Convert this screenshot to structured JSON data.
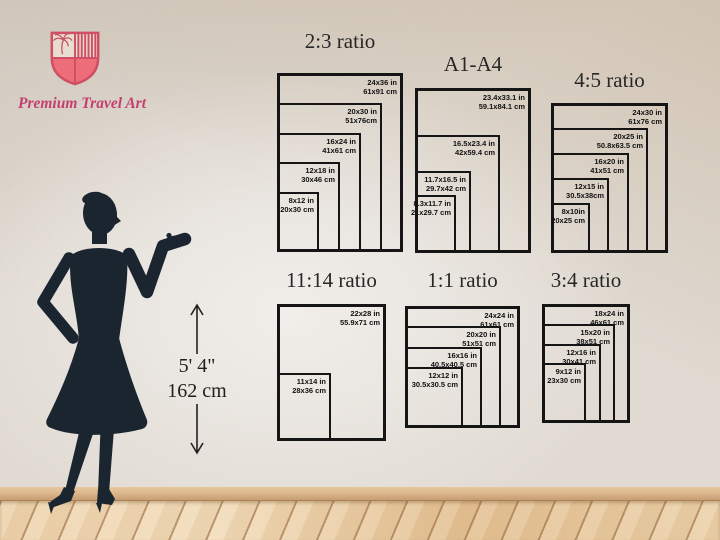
{
  "brand": {
    "name": "Premium Travel Art"
  },
  "height_marker": {
    "feet": "5' 4\"",
    "cm": "162 cm"
  },
  "colors": {
    "shield_outline": "#cf5064",
    "shield_fill": "#ee6d78",
    "brand_text": "#c43f6d",
    "silhouette": "#1b2530",
    "frame_border": "#151515",
    "wall": "#e0dad2",
    "floor_wood": "#ead0ab"
  },
  "groups": [
    {
      "title": "2:3 ratio",
      "title_top": 31,
      "frame": {
        "left": 277,
        "top": 73,
        "width": 126,
        "height": 179
      },
      "sizes": [
        {
          "label_in": "24x36 in",
          "label_cm": "61x91 cm",
          "w": 126,
          "h": 179
        },
        {
          "label_in": "20x30 in",
          "label_cm": "51x76cm",
          "w": 105,
          "h": 149
        },
        {
          "label_in": "16x24 in",
          "label_cm": "41x61 cm",
          "w": 84,
          "h": 119
        },
        {
          "label_in": "12x18 in",
          "label_cm": "30x46 cm",
          "w": 63,
          "h": 90
        },
        {
          "label_in": "8x12 in",
          "label_cm": "20x30 cm",
          "w": 42,
          "h": 60
        }
      ]
    },
    {
      "title": "A1-A4",
      "title_top": 54,
      "frame": {
        "left": 415,
        "top": 88,
        "width": 116,
        "height": 165
      },
      "sizes": [
        {
          "label_in": "23.4x33.1 in",
          "label_cm": "59.1x84.1 cm",
          "w": 116,
          "h": 165
        },
        {
          "label_in": "16.5x23.4 in",
          "label_cm": "42x59.4 cm",
          "w": 85,
          "h": 118
        },
        {
          "label_in": "11.7x16.5 in",
          "label_cm": "29.7x42 cm",
          "w": 56,
          "h": 82
        },
        {
          "label_in": "8.3x11.7 in",
          "label_cm": "21x29.7 cm",
          "w": 41,
          "h": 58
        }
      ]
    },
    {
      "title": "4:5 ratio",
      "title_top": 70,
      "frame": {
        "left": 551,
        "top": 103,
        "width": 117,
        "height": 150
      },
      "sizes": [
        {
          "label_in": "24x30 in",
          "label_cm": "61x76 cm",
          "w": 117,
          "h": 150
        },
        {
          "label_in": "20x25 in",
          "label_cm": "50.8x63.5 cm",
          "w": 97,
          "h": 125
        },
        {
          "label_in": "16x20 in",
          "label_cm": "41x51 cm",
          "w": 78,
          "h": 100
        },
        {
          "label_in": "12x15 in",
          "label_cm": "30.5x38cm",
          "w": 58,
          "h": 75
        },
        {
          "label_in": "8x10in",
          "label_cm": "20x25 cm",
          "w": 39,
          "h": 50
        }
      ]
    },
    {
      "title": "11:14 ratio",
      "title_top": 270,
      "frame": {
        "left": 277,
        "top": 304,
        "width": 109,
        "height": 137
      },
      "sizes": [
        {
          "label_in": "22x28 in",
          "label_cm": "55.9x71 cm",
          "w": 109,
          "h": 137
        },
        {
          "label_in": "11x14 in",
          "label_cm": "28x36 cm",
          "w": 54,
          "h": 68
        }
      ]
    },
    {
      "title": "1:1 ratio",
      "title_top": 270,
      "frame": {
        "left": 405,
        "top": 306,
        "width": 115,
        "height": 122
      },
      "sizes": [
        {
          "label_in": "24x24 in",
          "label_cm": "61x61 cm",
          "w": 115,
          "h": 122
        },
        {
          "label_in": "20x20 in",
          "label_cm": "51x51 cm",
          "w": 96,
          "h": 102
        },
        {
          "label_in": "16x16 in",
          "label_cm": "40.5x40.5 cm",
          "w": 77,
          "h": 81
        },
        {
          "label_in": "12x12 in",
          "label_cm": "30.5x30.5 cm",
          "w": 58,
          "h": 61
        }
      ]
    },
    {
      "title": "3:4 ratio",
      "title_top": 270,
      "frame": {
        "left": 542,
        "top": 304,
        "width": 88,
        "height": 119
      },
      "sizes": [
        {
          "label_in": "18x24 in",
          "label_cm": "46x61 cm",
          "w": 88,
          "h": 119
        },
        {
          "label_in": "15x20 in",
          "label_cm": "38x51 cm",
          "w": 73,
          "h": 99
        },
        {
          "label_in": "12x16 in",
          "label_cm": "30x41 cm",
          "w": 59,
          "h": 79
        },
        {
          "label_in": "9x12 in",
          "label_cm": "23x30 cm",
          "w": 44,
          "h": 60
        }
      ]
    }
  ]
}
